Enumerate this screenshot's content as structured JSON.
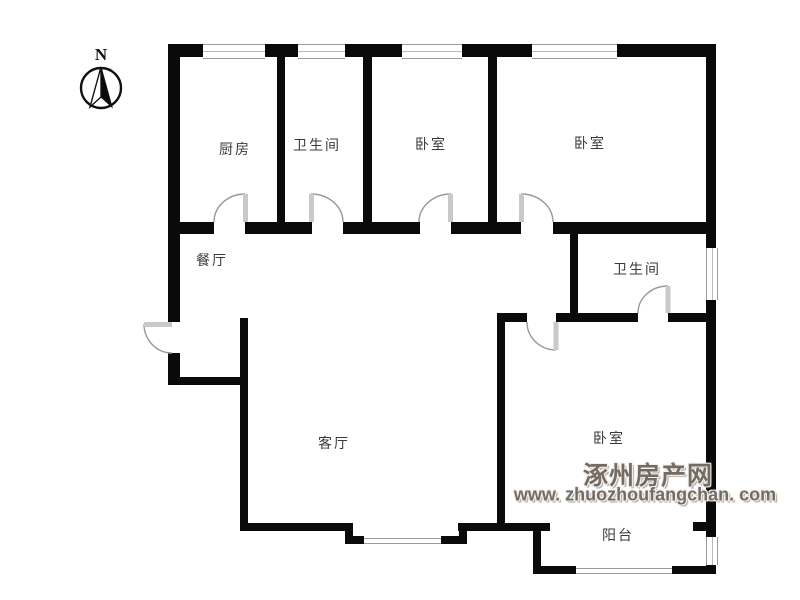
{
  "compass": {
    "label": "N"
  },
  "rooms": [
    {
      "id": "kitchen",
      "label": "厨房"
    },
    {
      "id": "bathroom-top",
      "label": "卫生间"
    },
    {
      "id": "bedroom-top-1",
      "label": "卧室"
    },
    {
      "id": "bedroom-top-2",
      "label": "卧室"
    },
    {
      "id": "dining-room",
      "label": "餐厅"
    },
    {
      "id": "bathroom-right",
      "label": "卫生间"
    },
    {
      "id": "living-room",
      "label": "客厅"
    },
    {
      "id": "bedroom-bottom",
      "label": "卧室"
    },
    {
      "id": "balcony",
      "label": "阳台"
    }
  ],
  "watermark": {
    "site_name": "涿州房产网",
    "site_url": "www. zhuozhoufangchan. com"
  },
  "colors": {
    "wall": "#0a0a0a",
    "window_frame": "#9c9c9c",
    "door_arc": "#999999",
    "door_leaf": "#c9c9c9",
    "room_label": "#3a3a3a",
    "watermark": "#756b61"
  }
}
